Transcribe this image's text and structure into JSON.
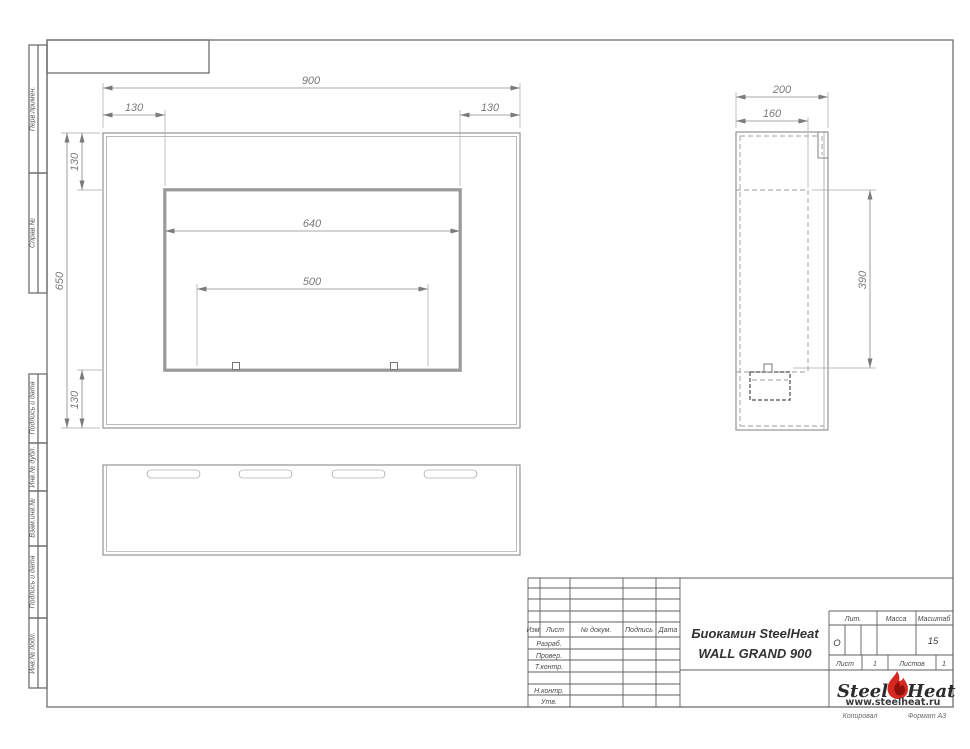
{
  "drawing": {
    "left_margin_labels": [
      "Перв.примен.",
      "Справ.№",
      "Подпись и дата",
      "Инв.№ дубл.",
      "Взам.инв.№",
      "Подпись и дата",
      "Инв.№ подл."
    ],
    "front_view": {
      "width": "900",
      "left": "130",
      "right": "130",
      "top": "130",
      "height": "650",
      "bottom": "130",
      "opening": "640",
      "burner": "500"
    },
    "side_view": {
      "depth": "200",
      "inner_depth": "160",
      "opening_height": "390"
    },
    "title_block": {
      "cols": {
        "izm": "Изм.",
        "list": "Лист",
        "doc": "№ докум.",
        "sign": "Подпись",
        "date": "Дата"
      },
      "rows": {
        "r0": "Разраб.",
        "r1": "Провер.",
        "r2": "Т.контр.",
        "r3": "Н.контр.",
        "r4": "Утв."
      },
      "title1": "Биокамин SteelHeat",
      "title2": "WALL GRAND 900",
      "lit": "Лит.",
      "lit_value": "О",
      "massa": "Масса",
      "scale": "Масштаб",
      "scale_value": "15",
      "sheet": "Лист",
      "sheet_no": "1",
      "sheets": "Листов",
      "sheets_no": "1"
    },
    "logo": {
      "steel": "Steel",
      "heat": "Heat",
      "url": "www.steelheat.ru",
      "flame_color": "#d6281f",
      "flame_inner": "#8f0f0a"
    },
    "footer": {
      "copy": "Копировал",
      "format": "Формат А3"
    }
  }
}
